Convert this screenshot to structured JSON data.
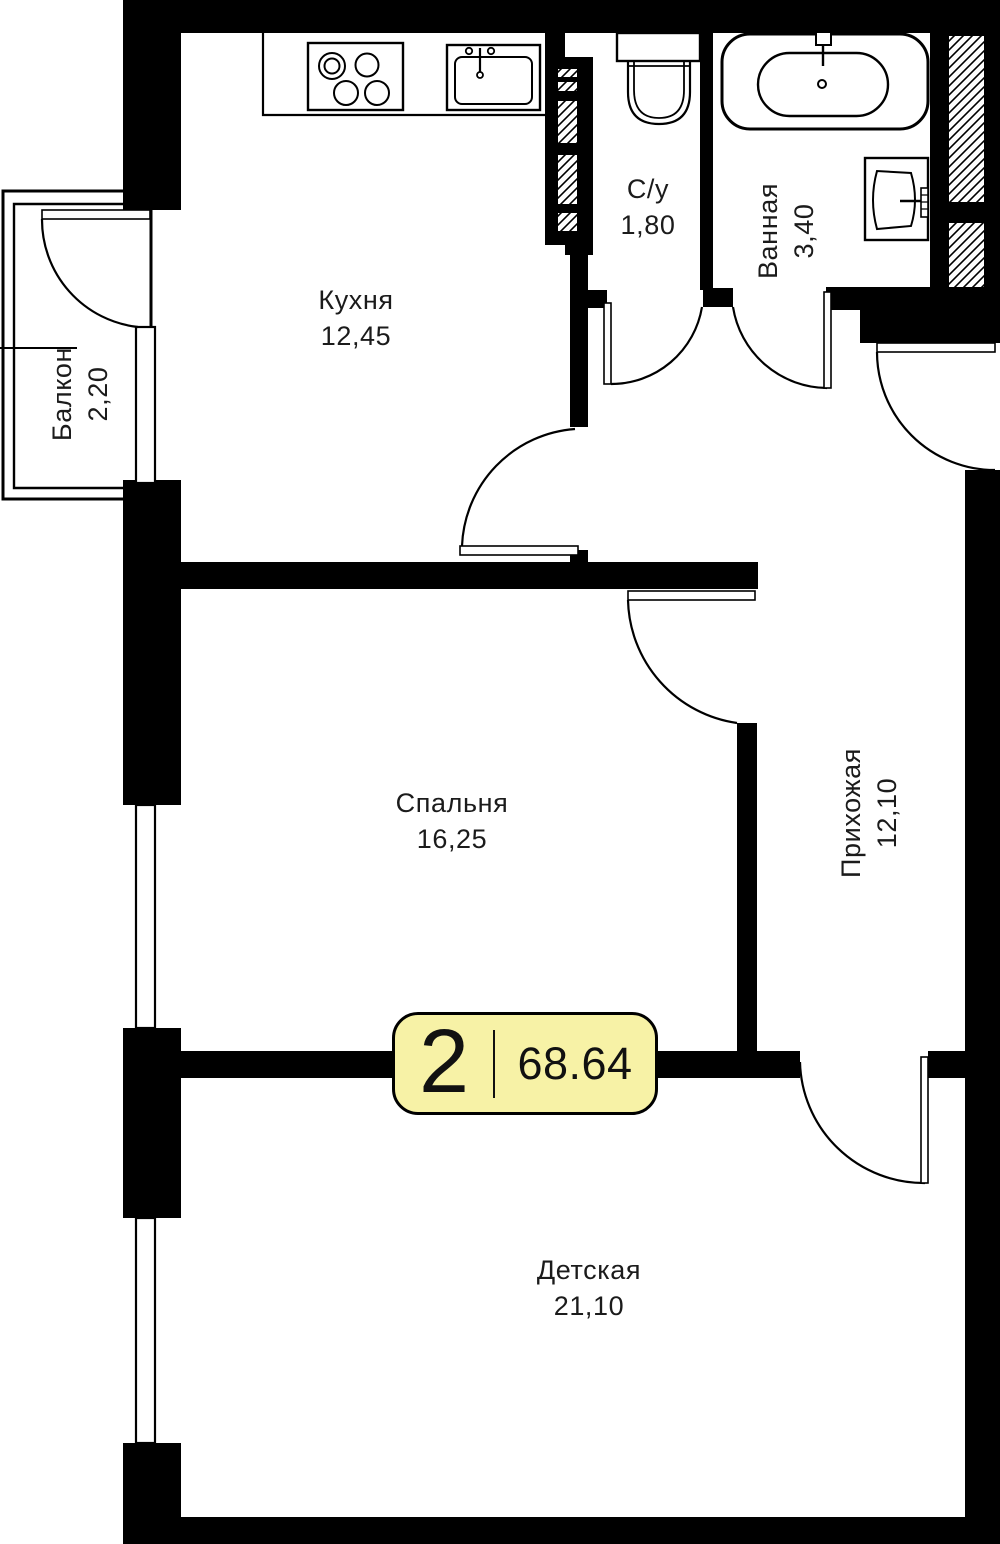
{
  "plan": {
    "title": "2-room apartment floor plan",
    "badge": {
      "rooms_count": "2",
      "total_area": "68.64"
    },
    "rooms": [
      {
        "id": "kitchen",
        "name": "Кухня",
        "area": "12,45"
      },
      {
        "id": "wc",
        "name": "С/у",
        "area": "1,80"
      },
      {
        "id": "bathroom",
        "name": "Ванная",
        "area": "3,40"
      },
      {
        "id": "balcony",
        "name": "Балкон",
        "area": "2,20"
      },
      {
        "id": "bedroom",
        "name": "Спальня",
        "area": "16,25"
      },
      {
        "id": "hallway",
        "name": "Прихожая",
        "area": "12,10"
      },
      {
        "id": "nursery",
        "name": "Детская",
        "area": "21,10"
      }
    ],
    "colors": {
      "wall": "#000000",
      "line": "#000000",
      "badge_bg": "#F7F2A6",
      "badge_border": "#000000",
      "text": "#1b1b1b"
    }
  }
}
